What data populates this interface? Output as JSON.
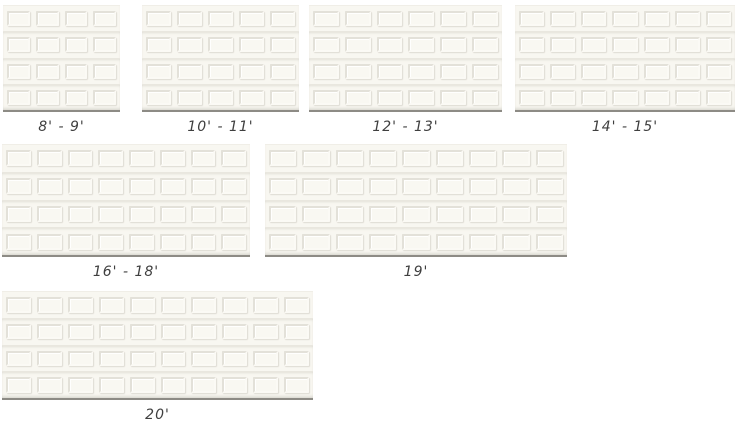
{
  "colors": {
    "page_background": "#ffffff",
    "door_face": "#f8f7f1",
    "panel_groove_dark": "#e3e1d9",
    "panel_groove_light": "#fbfaf5",
    "section_rail_line": "#e9e7df",
    "door_bottom_line": "#8d8b85",
    "label_text": "#3f3f3f"
  },
  "doors": [
    {
      "label": "8' - 9'",
      "columns": 4,
      "rows": 4
    },
    {
      "label": "10' - 11'",
      "columns": 5,
      "rows": 4
    },
    {
      "label": "12' - 13'",
      "columns": 6,
      "rows": 4
    },
    {
      "label": "14' - 15'",
      "columns": 7,
      "rows": 4
    },
    {
      "label": "16' - 18'",
      "columns": 8,
      "rows": 4
    },
    {
      "label": "19'",
      "columns": 9,
      "rows": 4
    },
    {
      "label": "20'",
      "columns": 10,
      "rows": 4
    }
  ]
}
